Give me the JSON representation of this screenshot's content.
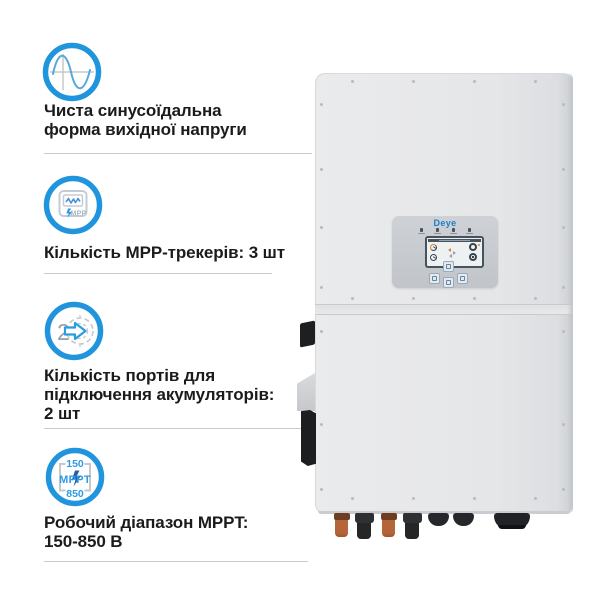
{
  "features": [
    {
      "id": "pure-sine-wave",
      "lines": [
        "Чиста синусоїдальна",
        "форма вихідної напруги"
      ]
    },
    {
      "id": "mpp-trackers",
      "lines": [
        "Кількість MPP-трекерів: 3 шт"
      ],
      "icon": {
        "label": "MPP"
      }
    },
    {
      "id": "battery-ports",
      "lines": [
        "Кількість портів для",
        "підключення акумуляторів:",
        "2 шт"
      ],
      "icon": {
        "number": "2"
      }
    },
    {
      "id": "mppt-range",
      "lines": [
        "Робочий діапазон MPPT:",
        "150-850 В"
      ],
      "icon": {
        "top": "150",
        "middle": "MPPT",
        "bottom": "850"
      }
    }
  ],
  "device": {
    "brand_logo": "Deye"
  },
  "colors": {
    "accent_blue": "#2095dd",
    "icon_detail_blue": "#2d9be3",
    "logo_blue": "#1b7fc6",
    "text_black": "#1b1b1b",
    "separator_gray": "#c9cacb",
    "device_body_gray": "#e6e7e9",
    "control_panel_gray": "#c7cbd0",
    "lcd_border": "#46525e",
    "gauge_orange": "#d9822e",
    "connector_orange": "#b5653a",
    "connector_black": "#242628"
  }
}
